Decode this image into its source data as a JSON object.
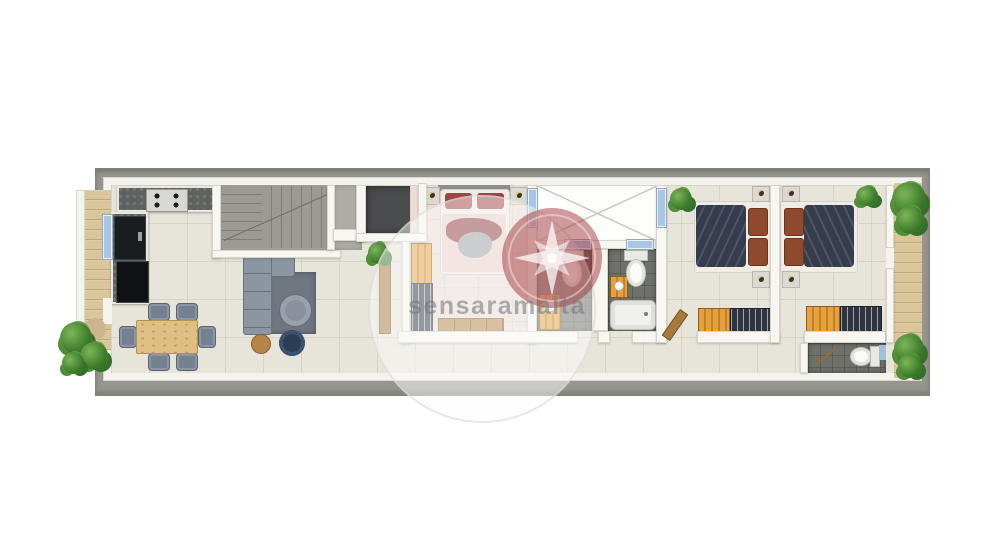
{
  "watermark": {
    "text": "sensaramalta",
    "logo": "compass-rose-icon"
  },
  "palette": {
    "page_background": "#ffffff",
    "concrete_outer_wall": "#96968e",
    "interior_wall": "#f7f6f1",
    "floor_tile": "#e7e4da",
    "master_bedroom_floor": "#ecdcd5",
    "bathroom_tile": "#6e716a",
    "stair_concrete": "#adaca6",
    "storage_floor": "#4a4c4d",
    "wood_deck": "#d9c69b",
    "window_glass": "#a9c7e4",
    "wardrobe_orange": "#e3a23c",
    "bed_navy": "#353c4e",
    "bed_maroon": "#8e3b40",
    "sofa_gray": "#8c96a0",
    "dining_table_wood": "#dfc084",
    "plant_green": "#3f7d2c",
    "watermark_logo_red": "#9e2c30"
  },
  "rooms": [
    {
      "id": "left-balcony"
    },
    {
      "id": "kitchen"
    },
    {
      "id": "dining-area"
    },
    {
      "id": "living-area"
    },
    {
      "id": "staircase"
    },
    {
      "id": "storage"
    },
    {
      "id": "master-bedroom"
    },
    {
      "id": "light-shaft"
    },
    {
      "id": "bathroom-1"
    },
    {
      "id": "bathroom-2"
    },
    {
      "id": "hallway"
    },
    {
      "id": "bedroom-2"
    },
    {
      "id": "bedroom-3"
    },
    {
      "id": "toilet-room"
    },
    {
      "id": "right-terrace"
    }
  ]
}
